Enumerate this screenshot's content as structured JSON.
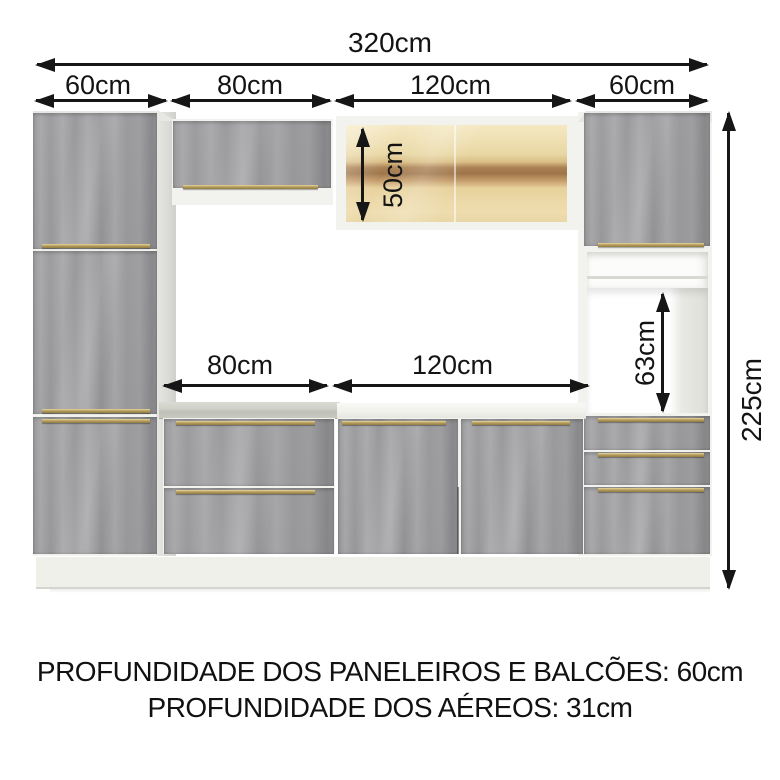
{
  "diagram_title": "kitchen cabinet dimension diagram",
  "dims": {
    "total_width": "320cm",
    "total_height": "225cm",
    "top_sections": [
      "60cm",
      "80cm",
      "120cm",
      "60cm"
    ],
    "glass_height": "50cm",
    "inner_widths": [
      "80cm",
      "120cm"
    ],
    "niche_height": "63cm"
  },
  "footer": {
    "line1": "PROFUNDIDADE DOS PANELEIROS E BALCÕES: 60cm",
    "line2": "PROFUNDIDADE DOS AÉREOS: 31cm"
  },
  "colors": {
    "door_gray": "#9d9d9f",
    "handle_gold": "#b3985c",
    "carcass_white": "#f2f2ef",
    "countertop_concrete": "#c9cac1",
    "countertop_white": "#f1f1ed",
    "glass_amber": "#ead7a4",
    "glass_shelf_brown": "#9e754a",
    "dimension_black": "#161616",
    "background": "#ffffff"
  }
}
